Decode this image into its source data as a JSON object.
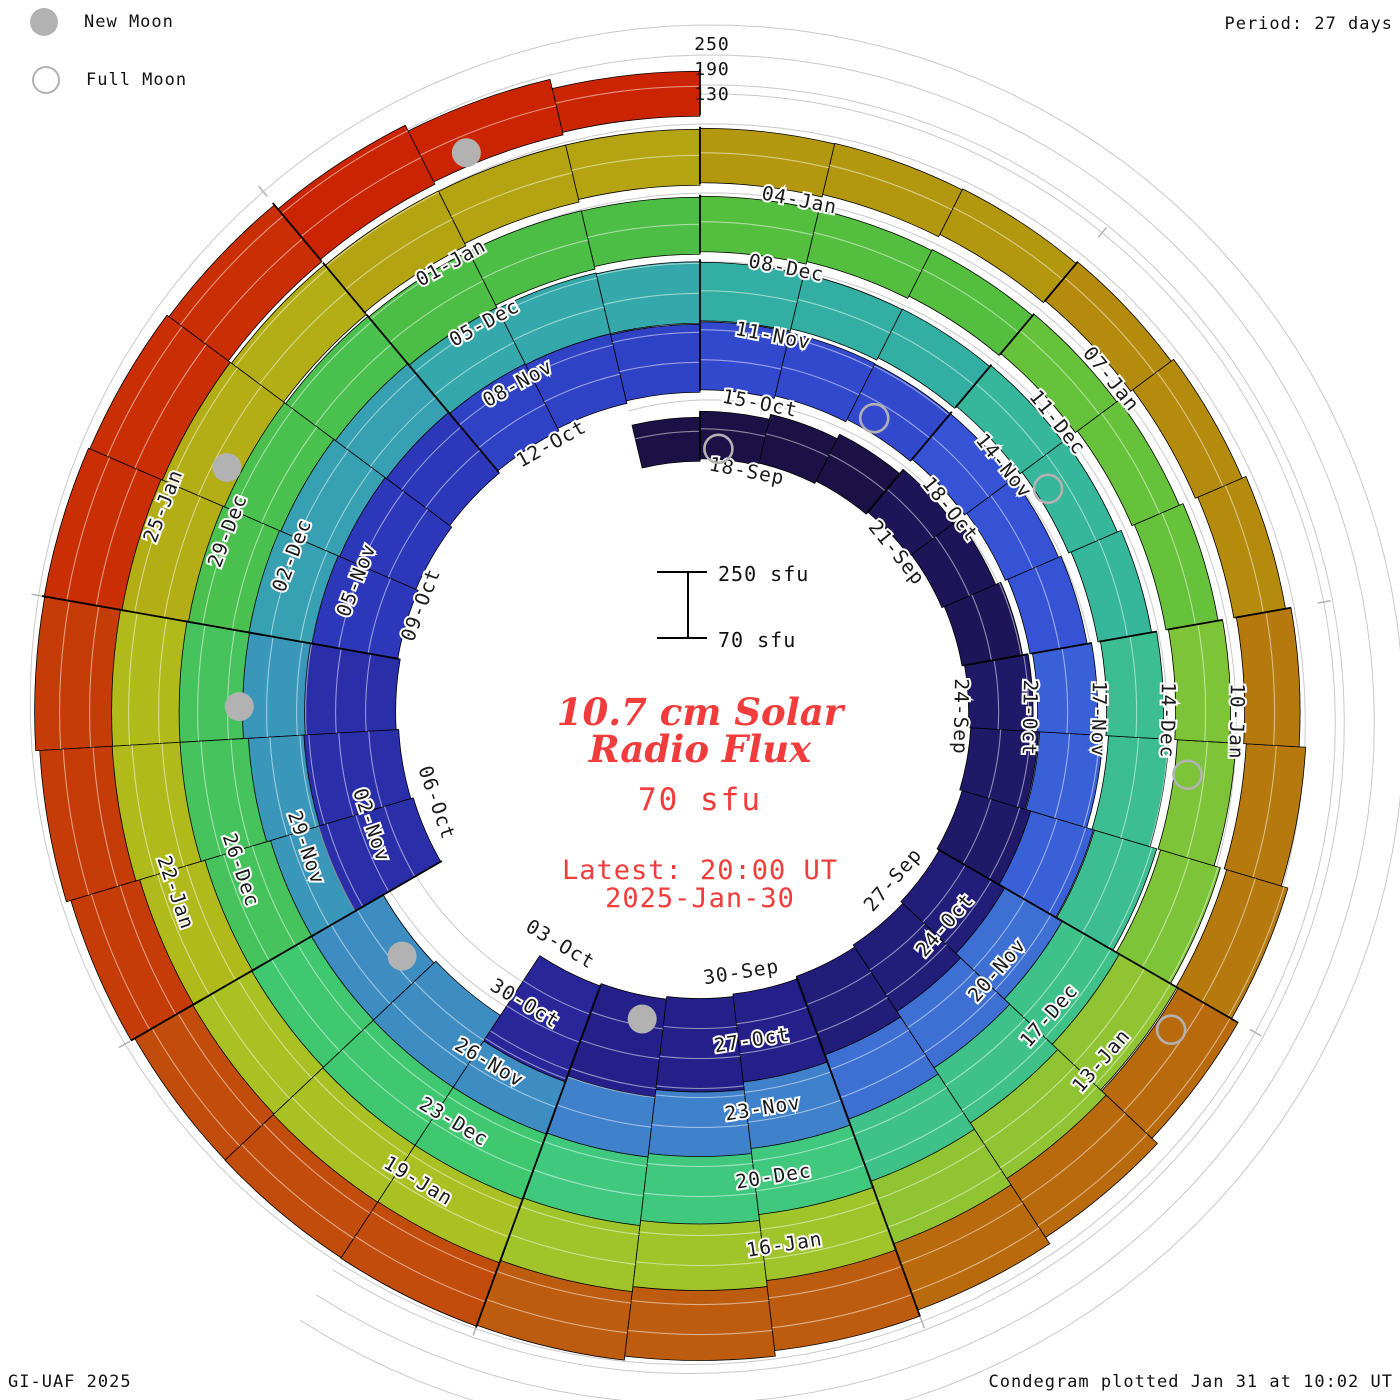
{
  "legend": {
    "new_moon": "New Moon",
    "full_moon": "Full Moon"
  },
  "period_label": "Period: 27 days",
  "radial_scale_labels": {
    "top": "250",
    "mid": "190",
    "bottom": "130"
  },
  "center": {
    "scale_top": "250 sfu",
    "scale_bottom": "70 sfu",
    "title_line1": "10.7 cm Solar",
    "title_line2": "Radio Flux",
    "current_value": "70 sfu",
    "latest_line1": "Latest: 20:00 UT",
    "latest_line2": "2025-Jan-30"
  },
  "footer": {
    "left": "GI-UAF 2025",
    "right": "Condegram plotted Jan 31 at 10:02 UT"
  },
  "colors": {
    "accent_red": "#f23b3b",
    "moon_gray": "#b2b2b2",
    "grid_gray": "#c9c9c9",
    "tick_gray": "#b3b3b3",
    "label_black": "#1a1a1a"
  },
  "chart_data": {
    "type": "bar",
    "subtype": "condegram-polar-spiral",
    "title": "10.7 cm Solar Radio Flux",
    "units": "sfu",
    "baseline_sfu": 70,
    "max_sfu": 250,
    "gridlines_sfu": [
      130,
      190,
      250
    ],
    "period_days": 27,
    "days_per_segment": 3,
    "start_date": "2024-09-17",
    "end_date": "2025-01-30",
    "segment_labels": [
      "18-Sep",
      "21-Sep",
      "24-Sep",
      "27-Sep",
      "30-Sep",
      "03-Oct",
      "06-Oct",
      "09-Oct",
      "12-Oct",
      "15-Oct",
      "18-Oct",
      "21-Oct",
      "24-Oct",
      "27-Oct",
      "30-Oct",
      "02-Nov",
      "05-Nov",
      "08-Nov",
      "11-Nov",
      "14-Nov",
      "17-Nov",
      "20-Nov",
      "23-Nov",
      "26-Nov",
      "29-Nov",
      "02-Dec",
      "05-Dec",
      "08-Dec",
      "11-Dec",
      "14-Dec",
      "17-Dec",
      "20-Dec",
      "23-Dec",
      "26-Dec",
      "29-Dec",
      "01-Jan",
      "04-Jan",
      "07-Jan",
      "10-Jan",
      "13-Jan",
      "16-Jan",
      "19-Jan",
      "22-Jan",
      "25-Jan"
    ],
    "segment_colors": [
      "#1b1147",
      "#1d1558",
      "#1f1968",
      "#221d79",
      "#252089",
      "#282699",
      "#2a2ea9",
      "#2c38b9",
      "#2f42c6",
      "#3249ce",
      "#3553d4",
      "#3a60d7",
      "#3d70d2",
      "#3f81ca",
      "#3e8dc2",
      "#3b97ba",
      "#37a0b2",
      "#34a8aa",
      "#32afa2",
      "#36b69a",
      "#3cbd92",
      "#3fc289",
      "#40c87e",
      "#3fc870",
      "#46c35c",
      "#4ac04e",
      "#4cbd45",
      "#54be3e",
      "#66c13b",
      "#7ec439",
      "#90c432",
      "#a0c42a",
      "#a9c122",
      "#b0ba1b",
      "#b3ae15",
      "#b4a411",
      "#b3980f",
      "#b58b0e",
      "#b5790d",
      "#b96a0d",
      "#bd5c0e",
      "#c24c0c",
      "#c63c08",
      "#c92e05",
      "#cb2403"
    ],
    "daily_flux": [
      158,
      165,
      170,
      175,
      181,
      187,
      193,
      199,
      206,
      213,
      221,
      229,
      237,
      247,
      257,
      267,
      274,
      null,
      null,
      268,
      260,
      252,
      244,
      236,
      228,
      220,
      213,
      206,
      206,
      200,
      194,
      189,
      186,
      186,
      190,
      197,
      206,
      216,
      226,
      236,
      243,
      248,
      250,
      247,
      242,
      236,
      230,
      233,
      238,
      234,
      226,
      217,
      208,
      200,
      193,
      187,
      183,
      179,
      177,
      176,
      179,
      184,
      191,
      200,
      210,
      220,
      230,
      238,
      245,
      250,
      248,
      243,
      236,
      229,
      232,
      227,
      219,
      211,
      203,
      196,
      190,
      184,
      181,
      177,
      174,
      173,
      173,
      176,
      180,
      187,
      195,
      205,
      215,
      225,
      233,
      240,
      245,
      245,
      241,
      234,
      227,
      230,
      224,
      216,
      208,
      200,
      193,
      187,
      182,
      179,
      175,
      172,
      171,
      172,
      175,
      181,
      189,
      198,
      208,
      218,
      228,
      236,
      242,
      245,
      242,
      236,
      230,
      233,
      237,
      240,
      236,
      228,
      218,
      202,
      184,
      160
    ],
    "moons": [
      {
        "day": 1,
        "date": "18-Sep",
        "type": "full"
      },
      {
        "day": 15,
        "date": "02-Oct",
        "type": "new"
      },
      {
        "day": 30,
        "date": "17-Oct",
        "type": "full"
      },
      {
        "day": 45,
        "date": "01-Nov",
        "type": "new"
      },
      {
        "day": 59,
        "date": "15-Nov",
        "type": "full"
      },
      {
        "day": 75,
        "date": "01-Dec",
        "type": "new"
      },
      {
        "day": 89,
        "date": "15-Dec",
        "type": "full"
      },
      {
        "day": 104,
        "date": "30-Dec",
        "type": "new"
      },
      {
        "day": 118,
        "date": "13-Jan",
        "type": "full"
      },
      {
        "day": 134,
        "date": "29-Jan",
        "type": "new"
      }
    ],
    "layout": {
      "cx": 700,
      "cy": 712,
      "r0": 252,
      "radius_step_per_turn": 69,
      "px_per_sfu": 0.5,
      "degrees_per_day": 13.3333,
      "label_angle_offset_deg": 11,
      "label_inset_px": 13,
      "legend_position": "top-left",
      "grid": true
    }
  }
}
